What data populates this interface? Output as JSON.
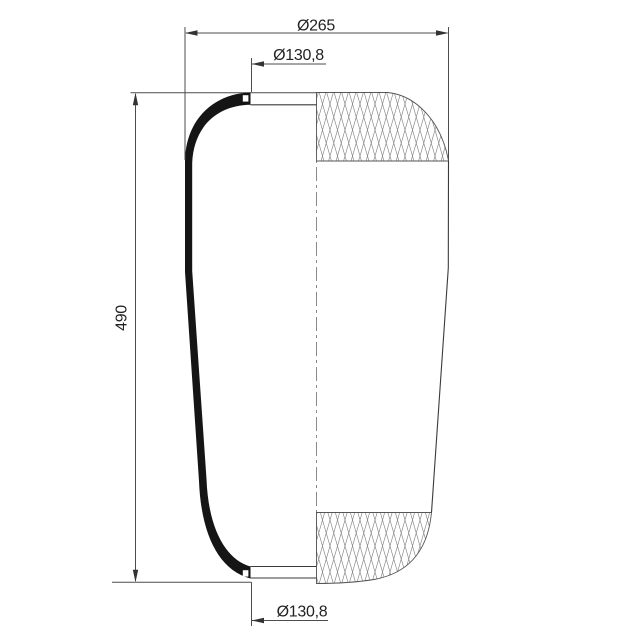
{
  "page": {
    "background": "#ffffff"
  },
  "drawing": {
    "type": "technical-drawing",
    "subject": "air-spring-bellows-half-section",
    "view": "front-half-section-with-knurled-end-zones",
    "labels": {
      "overall_diameter": "Ø265",
      "top_plate_diameter": "Ø130,8",
      "height": "490",
      "bottom_plate_diameter": "Ø130,8"
    },
    "colors": {
      "outline": "#3a3a3a",
      "dimension_lines": "#4d4d4d",
      "section_fill": "#151515",
      "mesh_lines": "#828282",
      "text": "#222222",
      "background": "#ffffff"
    }
  }
}
